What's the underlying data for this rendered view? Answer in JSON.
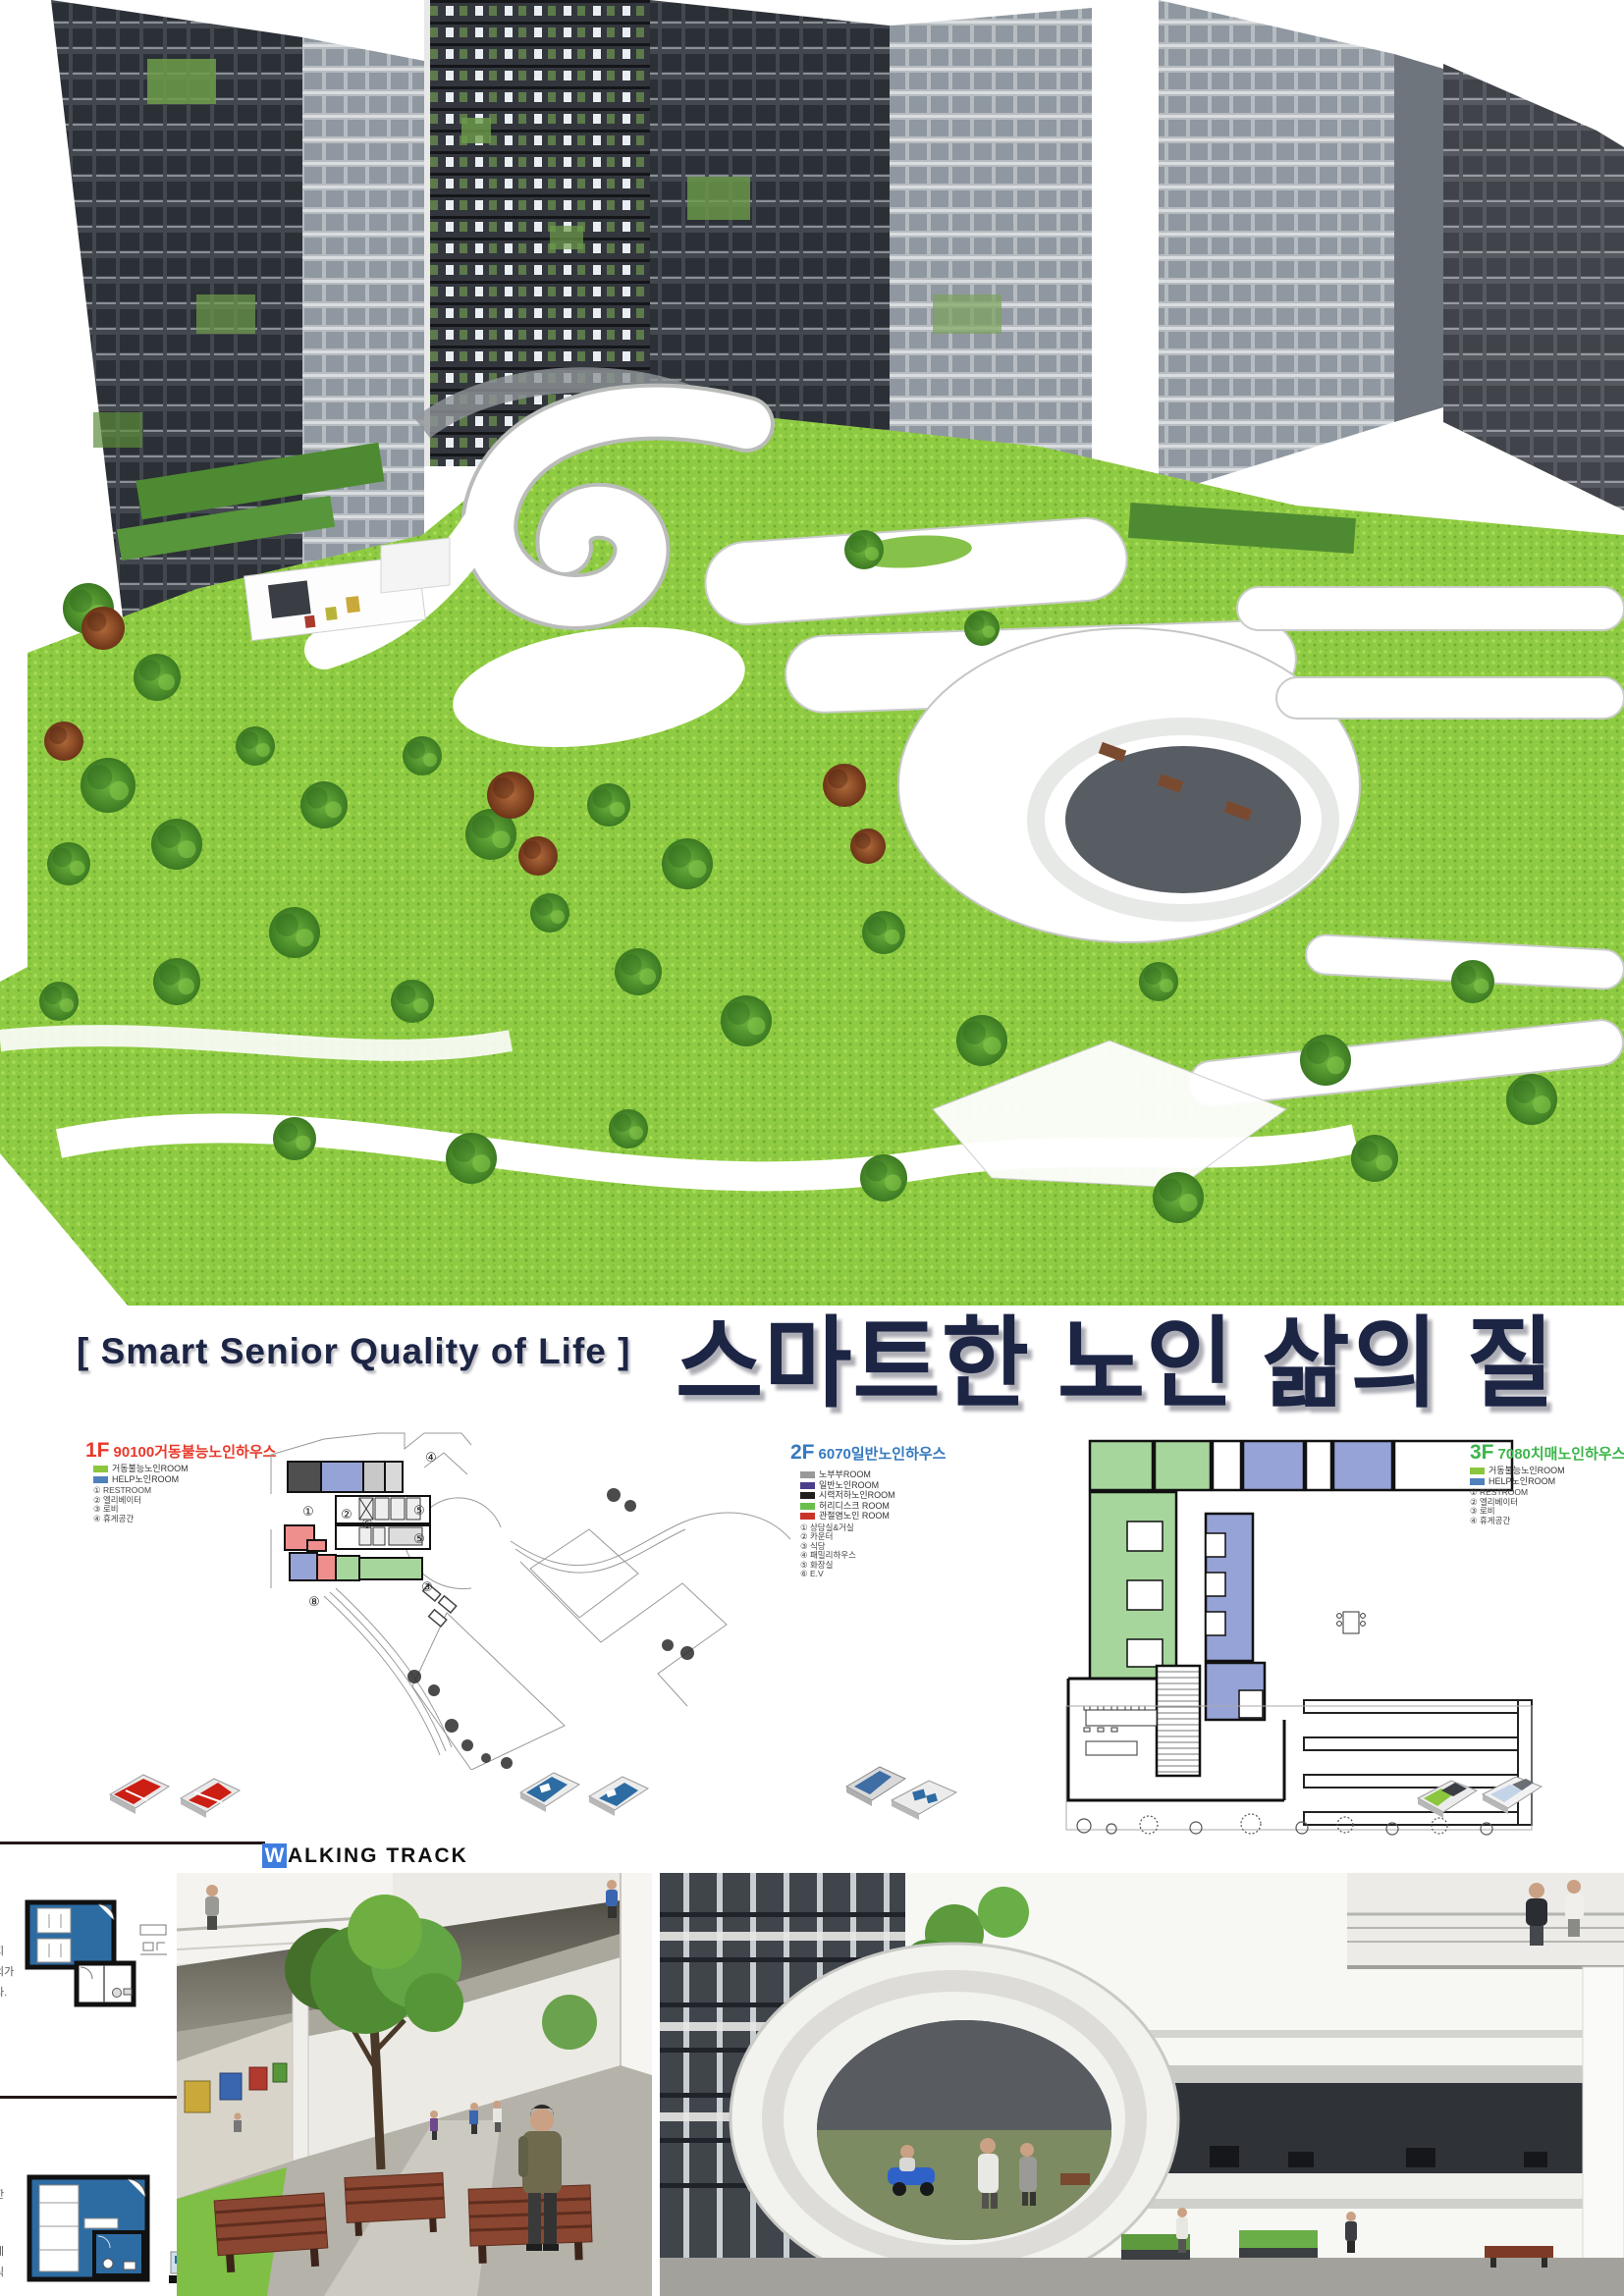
{
  "poster": {
    "title_en": "[ Smart Senior Quality of Life ]",
    "title_ko": "스마트한 노인 삶의 질"
  },
  "plans": [
    {
      "floor": "1F",
      "name": "90100거동불능노인하우스",
      "accent": "#e8392b",
      "rooms": [
        {
          "label": "거동불능노인ROOM",
          "color": "#8cc63f"
        },
        {
          "label": "HELP노인ROOM",
          "color": "#4f81bd"
        }
      ],
      "keys": [
        "① RESTROOM",
        "② 엘리베이터",
        "③ 로비",
        "④ 휴게공간"
      ]
    },
    {
      "floor": "2F",
      "name": "6070일반노인하우스",
      "accent": "#3579be",
      "rooms": [
        {
          "label": "노부부ROOM",
          "color": "#999999"
        },
        {
          "label": "일반노인ROOM",
          "color": "#4b3f8c"
        },
        {
          "label": "시력저하노인ROOM",
          "color": "#1e1e1e"
        },
        {
          "label": "허리디스크 ROOM",
          "color": "#6abf4b"
        },
        {
          "label": "관절염노인 ROOM",
          "color": "#c9342a"
        }
      ],
      "keys": [
        "① 상담실&거실",
        "② 카운터",
        "③ 식당",
        "④ 패밀리하우스",
        "⑤ 화장실",
        "⑥ E.V"
      ]
    },
    {
      "floor": "3F",
      "name": "7080치매노인하우스",
      "accent": "#3cb54a",
      "rooms": [
        {
          "label": "거동불능노인ROOM",
          "color": "#8cc63f"
        },
        {
          "label": "HELP노인ROOM",
          "color": "#4f81bd"
        }
      ],
      "keys": [
        "① RESTROOM",
        "② 엘리베이터",
        "③ 로비",
        "④ 휴게공간"
      ]
    }
  ],
  "plan1_markers": [
    "④",
    "①",
    "②",
    "⑥",
    "⑤",
    "⑤",
    "③",
    "⑧"
  ],
  "walking_track": {
    "first": "W",
    "rest": "ALKING TRACK"
  },
  "margin_notes": {
    "upper": [
      "지",
      "의가",
      "다."
    ],
    "lower": [
      "한",
      "세",
      "식"
    ]
  }
}
